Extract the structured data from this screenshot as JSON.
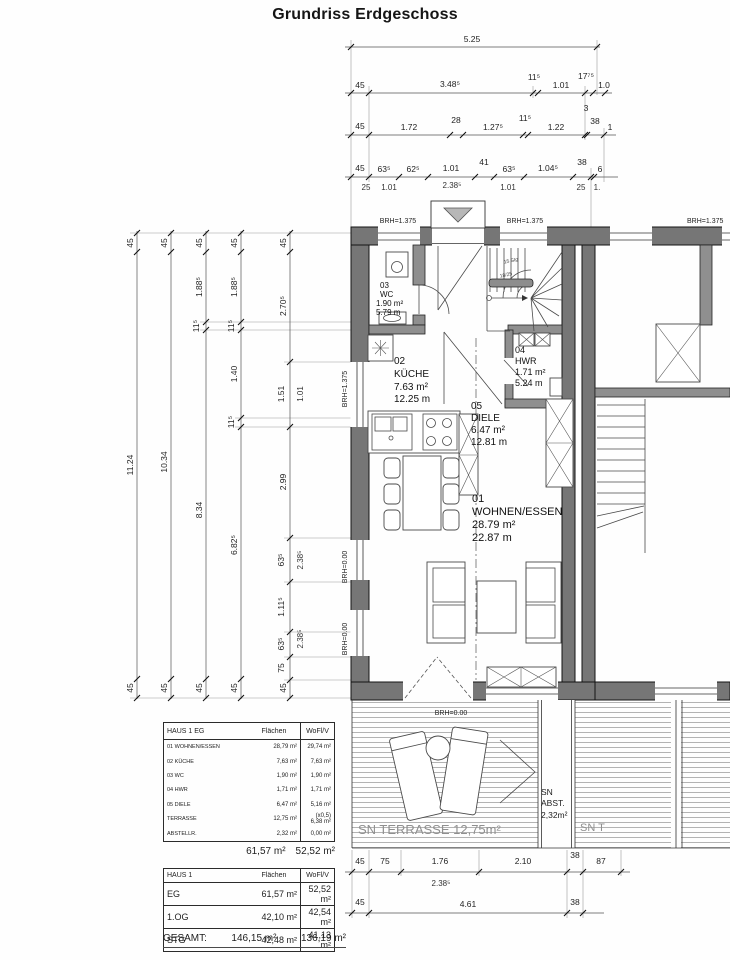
{
  "title": "Grundriss Erdgeschoss",
  "rooms": {
    "wc": {
      "id": "03",
      "name": "WC",
      "area": "1.90 m²",
      "per": "5.79 m"
    },
    "kueche": {
      "id": "02",
      "name": "KÜCHE",
      "area": "7.63 m²",
      "per": "12.25 m"
    },
    "hwr": {
      "id": "04",
      "name": "HWR",
      "area": "1.71 m²",
      "per": "5.24 m"
    },
    "diele": {
      "id": "05",
      "name": "DIELE",
      "area": "6.47 m²",
      "per": "12.81 m"
    },
    "wohnen": {
      "id": "01",
      "name": "WOHNEN/ESSEN",
      "area": "28.79 m²",
      "per": "22.87 m"
    }
  },
  "labels": {
    "brh_1375": "BRH=1.375",
    "brh_000": "BRH=0.00",
    "terrasse": "SN TERRASSE 12,75m²",
    "abst1": "SN",
    "abst2": "ABST.",
    "abst3": "2,32m²",
    "neighbor_sn": "SN T",
    "stair1": "15 Stg",
    "stair2": "18/25"
  },
  "dims": {
    "top1": "5.25",
    "top2": [
      "45",
      "3.48⁵",
      "11⁵",
      "1.01",
      "17⁷⁵",
      "1.0"
    ],
    "top3": [
      "45",
      "1.72",
      "28",
      "1.27⁵",
      "11⁵",
      "1.22",
      "3",
      "38",
      "1"
    ],
    "top4": [
      "45",
      "63⁵",
      "62⁵",
      "1.01",
      "41",
      "63⁵",
      "1.04⁵",
      "38",
      "6"
    ],
    "top4sub": [
      "25",
      "1.01",
      "2.38⁵",
      "1.01",
      "25",
      "1."
    ],
    "left1": [
      "45",
      "11.24",
      "45"
    ],
    "left2": [
      "45",
      "10.34",
      "45"
    ],
    "left3": [
      "45",
      "1.88⁵",
      "11⁵",
      "8.34",
      "45"
    ],
    "left4": [
      "45",
      "1.88⁵",
      "11⁵",
      "1.40",
      "11⁵",
      "6.82⁵",
      "45"
    ],
    "left5": [
      "45",
      "2.70⁵",
      "1.51",
      "2.99",
      "63⁵",
      "1.11⁵",
      "63⁵",
      "75",
      "45"
    ],
    "left5sub": [
      "1.01",
      "2.38⁵",
      "2.38⁵"
    ],
    "bottom1": [
      "45",
      "75",
      "1.76",
      "2.10",
      "38",
      "87"
    ],
    "bottom1sub": "2.38⁵",
    "bottom2": [
      "45",
      "4.61",
      "38"
    ]
  },
  "t1": {
    "h": [
      "HAUS 1 EG",
      "Flächen",
      "WoFl/V"
    ],
    "r0": [
      "01 WOHNEN/ESSEN",
      "28,79 m²",
      "29,74 m²"
    ],
    "r1": [
      "02 KÜCHE",
      "7,63 m²",
      "7,63 m²"
    ],
    "r2": [
      "03 WC",
      "1,90 m²",
      "1,90 m²"
    ],
    "r3": [
      "04 HWR",
      "1,71 m²",
      "1,71 m²"
    ],
    "r4": [
      "05 DIELE",
      "6,47 m²",
      "5,16 m²"
    ],
    "r5": [
      "TERRASSE",
      "12,75 m²",
      "(x0,5) 6,38 m²"
    ],
    "r6": [
      "ABSTELLR.",
      "2,32 m²",
      "0,00 m²"
    ],
    "sum_f": "61,57 m²",
    "sum_w": "52,52 m²"
  },
  "t2": {
    "h": [
      "HAUS 1",
      "Flächen",
      "WoFl/V"
    ],
    "r0": [
      "EG",
      "61,57 m²",
      "52,52 m²"
    ],
    "r1": [
      "1.OG",
      "42,10 m²",
      "42,54 m²"
    ],
    "r2": [
      "STG",
      "42,48 m²",
      "41,13 m²"
    ],
    "total_label": "GESAMT:",
    "total_f": "146,15 m²",
    "total_w": "136,19 m²"
  }
}
